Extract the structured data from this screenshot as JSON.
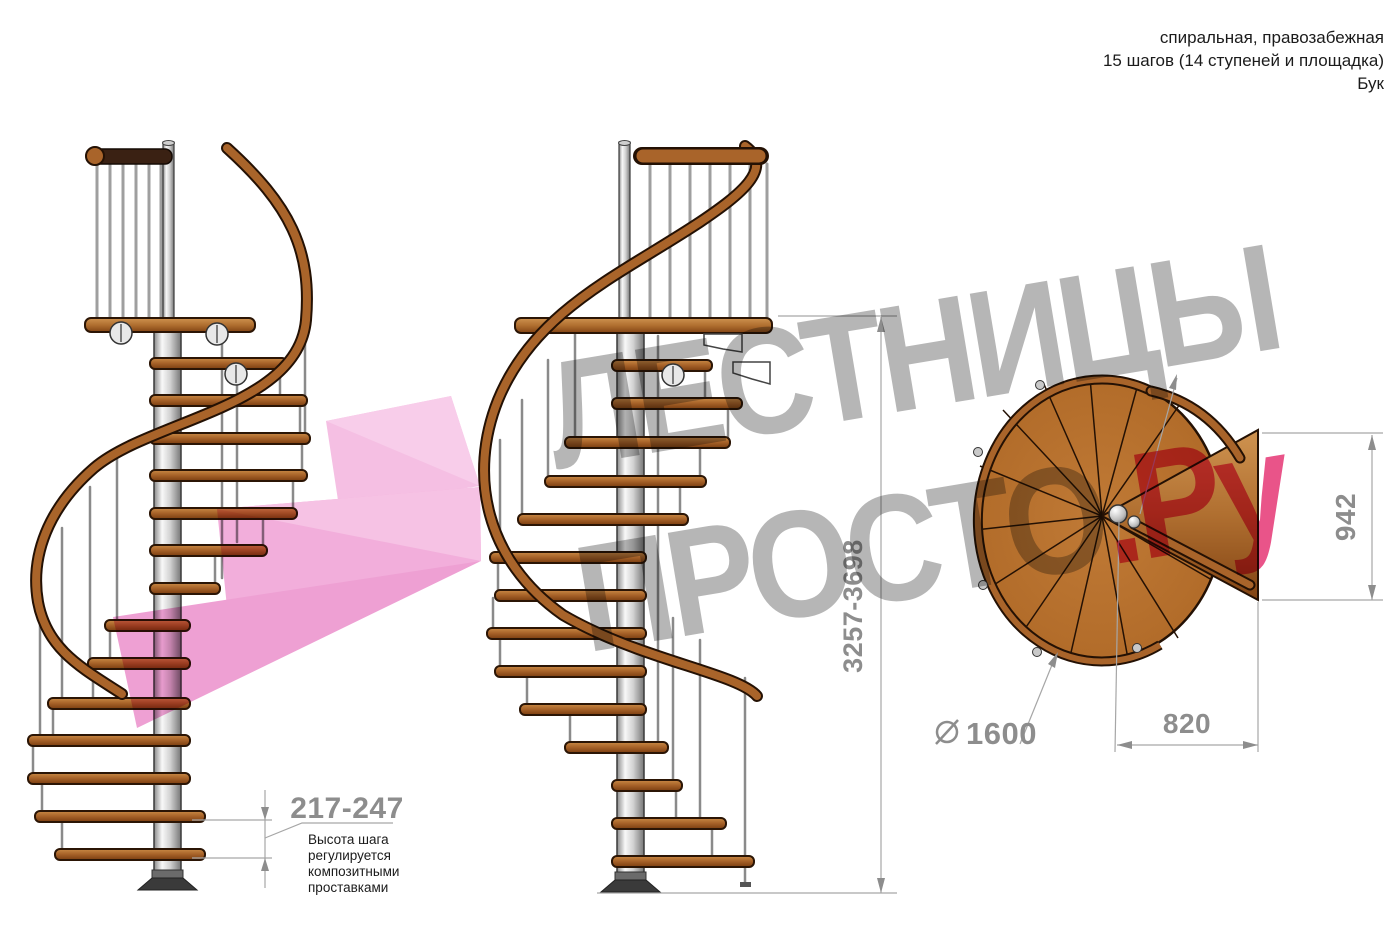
{
  "header": {
    "line1": "спиральная, правозабежная",
    "line2": "15 шагов (14 ступеней и площадка)",
    "line3": "Бук"
  },
  "watermark": {
    "line1": "ЛЕСТНИЦЫ",
    "line2_gray": "ПРОСТО",
    "line2_pink": ".Ру"
  },
  "dimensions": {
    "total_height": "3257-3698",
    "step_height": "217-247",
    "plan_height": "942",
    "plan_width": "820",
    "diameter_symbol": "⌀",
    "diameter_value": "1600"
  },
  "note": {
    "line1": "Высота шага",
    "line2": "регулируется",
    "line3": "композитными",
    "line4": "проставками"
  },
  "colors": {
    "wood": "#a9642a",
    "wood_dark": "#3a2113",
    "metal_pole": "#d9d9d9",
    "dimension_gray": "#8d8d8d",
    "watermark_gray": "#b0b0b0",
    "watermark_pink": "#e8457f",
    "arrow_pink": "#f2aedb"
  }
}
